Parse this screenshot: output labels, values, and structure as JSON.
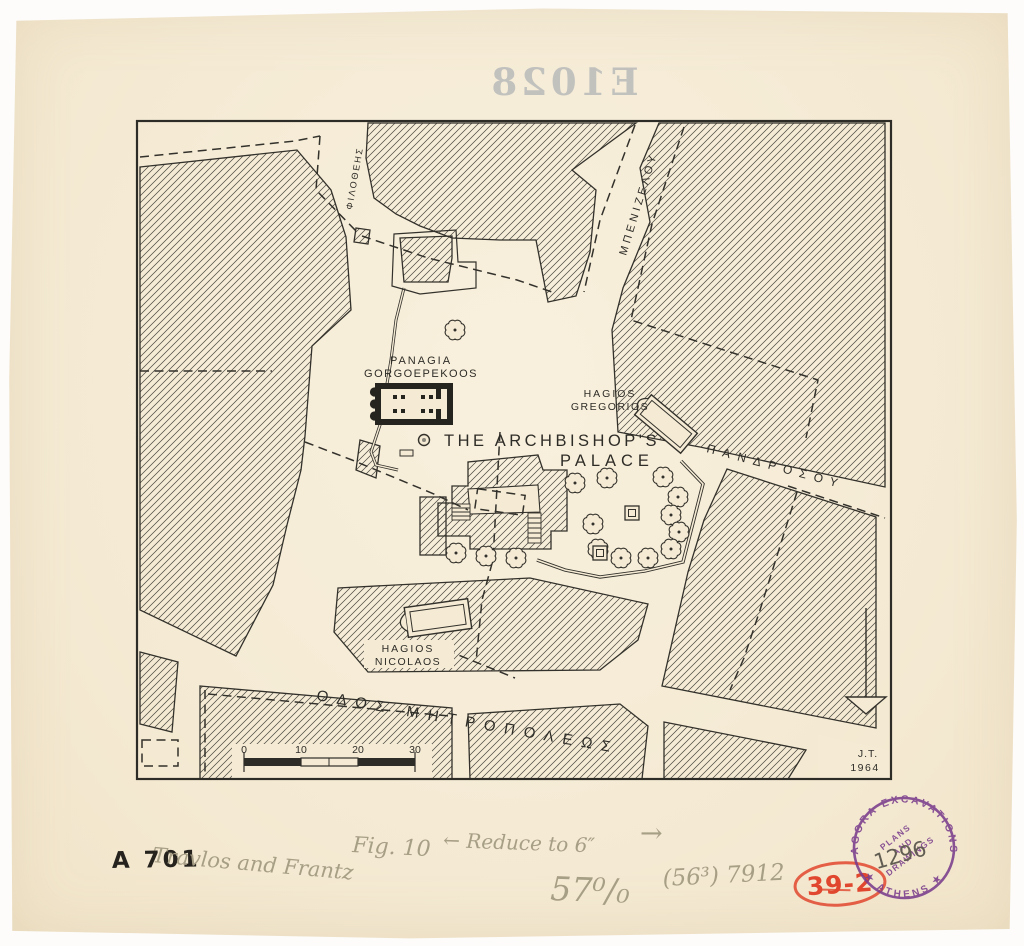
{
  "paper": {
    "bleed_number": "E1028"
  },
  "map": {
    "church_label": {
      "line1": "PANAGIA",
      "line2": "GORGOEPEKOOS"
    },
    "gregorios_label": {
      "line1": "HAGIOS",
      "line2": "GREGORIOS"
    },
    "palace_label": {
      "line1": "THE ARCHBISHOP'S",
      "line2": "PALACE"
    },
    "nicolaos_label": {
      "line1": "HAGIOS",
      "line2": "NICOLAOS"
    },
    "streets": {
      "philotheis": "ΦΙΛΟΘΕΗΣ",
      "benizelou": "ΜΠΕΝΙΖΕΛΟΥ",
      "pandrosou": "ΠΑΝΔΡΟΣΟΥ",
      "mitropoleos": "ΟΔΟΣ ΜΗΤΡΟΠΟΛΕΩΣ"
    },
    "scale_bar": {
      "ticks": [
        "0",
        "10",
        "20",
        "30"
      ]
    },
    "signature": {
      "initials": "J.T.",
      "year": "1964"
    }
  },
  "annotations": {
    "catalog_number": "A 701",
    "authors": "Travlos and Frantz",
    "figure": "Fig. 10",
    "reduce_note": "← Reduce to 6″",
    "arrow_right": "→",
    "percent": "57⁰/₀",
    "print_numbers": "(56³) 7912",
    "red_number": "39-2"
  },
  "stamp": {
    "arc_top": "AGORA EXCAVATIONS",
    "arc_bottom": "★ ATHENS ★",
    "line1": "PLANS",
    "line2": "AND",
    "line3": "DRAWINGS",
    "number": "1296",
    "ink_color": "#7a3d8c"
  },
  "colors": {
    "paper": "#f5ebd5",
    "ink": "#2e2c27",
    "pencil": "#a79e86",
    "red": "#e0472e",
    "stamp": "#7a3d8c"
  }
}
